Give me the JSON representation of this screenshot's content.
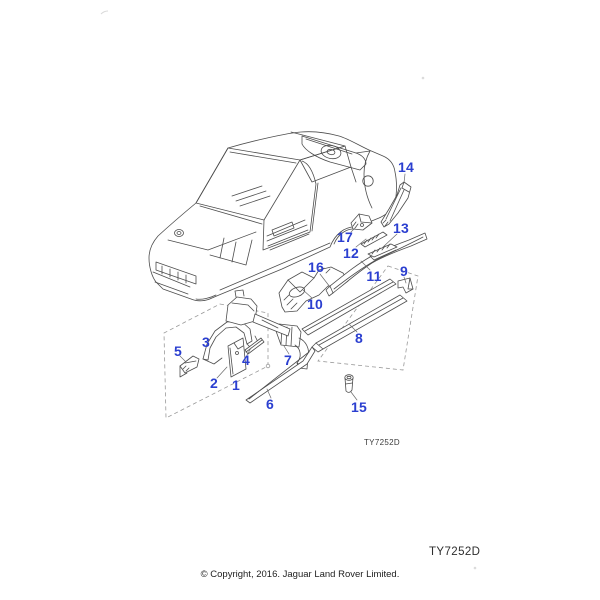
{
  "colors": {
    "callout_blue": "#2b3fd0",
    "line_gray": "#4d4d4d",
    "dashed_gray": "#999999",
    "background": "#ffffff"
  },
  "callouts": [
    {
      "label": "1"
    },
    {
      "label": "2"
    },
    {
      "label": "3"
    },
    {
      "label": "4"
    },
    {
      "label": "5"
    },
    {
      "label": "6"
    },
    {
      "label": "7"
    },
    {
      "label": "8"
    },
    {
      "label": "9"
    },
    {
      "label": "10"
    },
    {
      "label": "11"
    },
    {
      "label": "12"
    },
    {
      "label": "13"
    },
    {
      "label": "14"
    },
    {
      "label": "15"
    },
    {
      "label": "16"
    },
    {
      "label": "17"
    }
  ],
  "figure_code": "TY7252D",
  "page_code": "TY7252D",
  "copyright": "© Copyright, 2016. Jaguar Land Rover Limited."
}
